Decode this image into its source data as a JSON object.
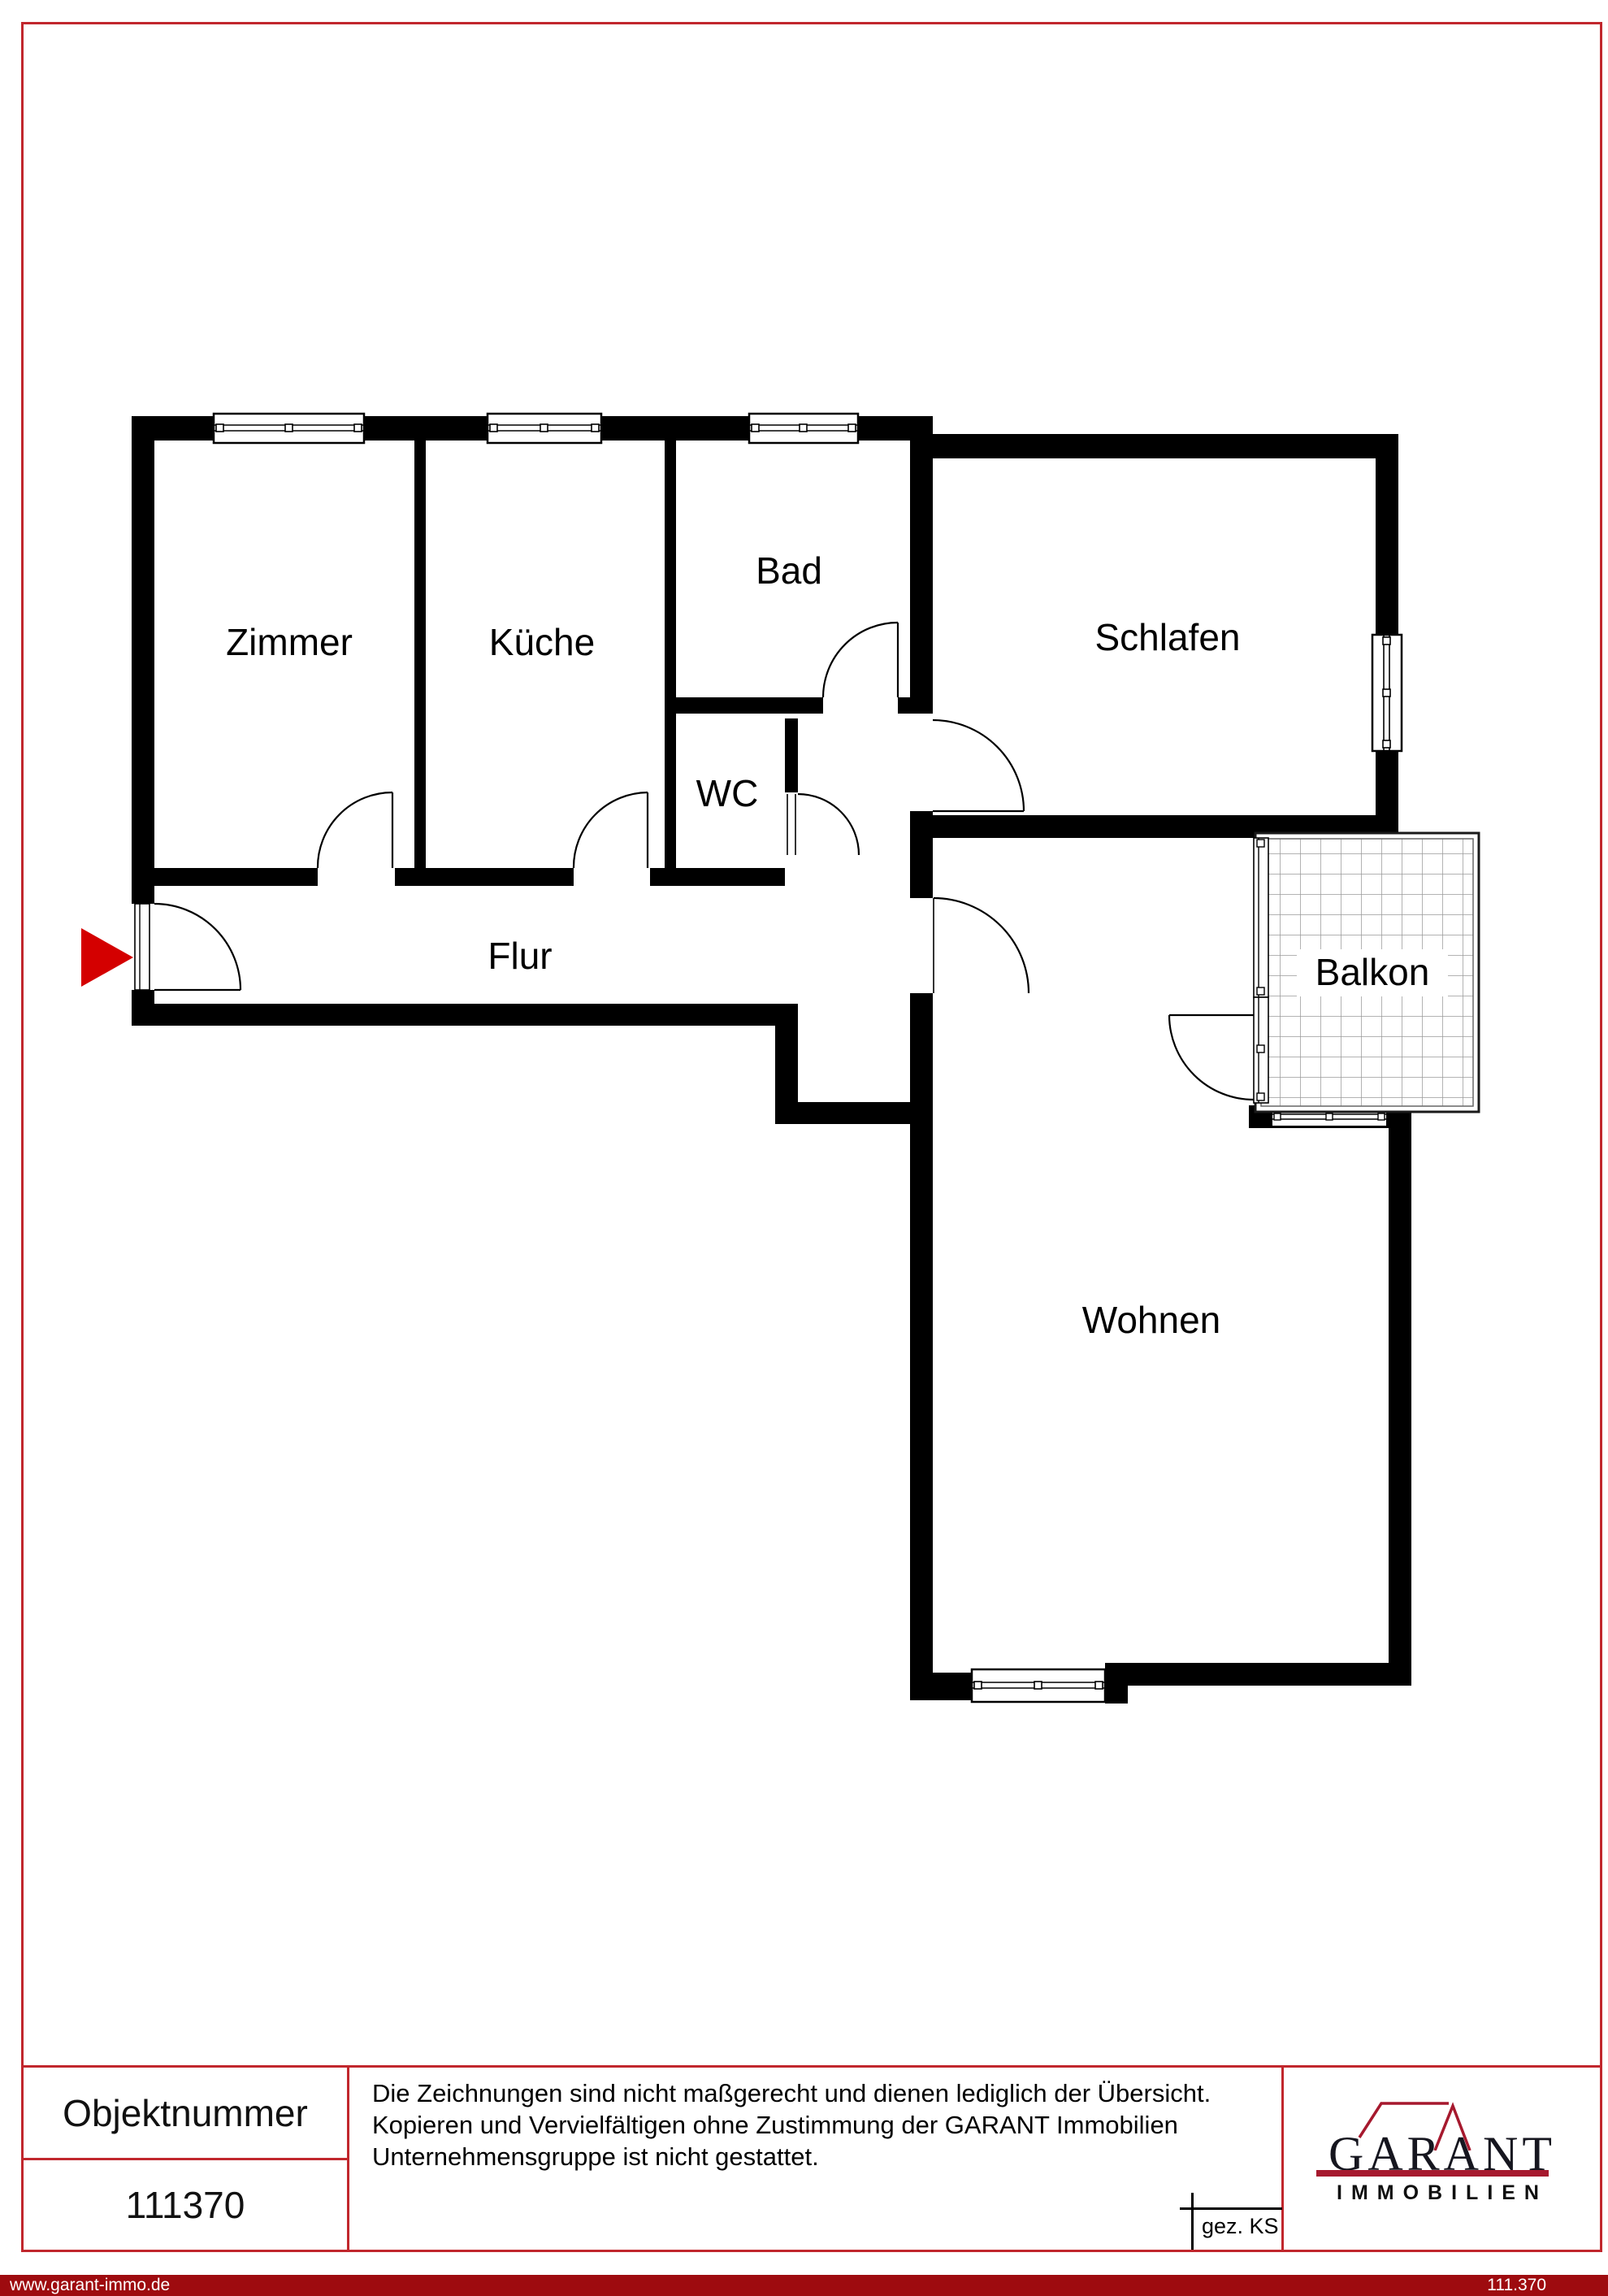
{
  "page": {
    "background": "#ffffff",
    "border_color": "#c1272d",
    "wall_color": "#000000"
  },
  "floor_plan": {
    "labels": {
      "zimmer": "Zimmer",
      "kueche": "Küche",
      "bad": "Bad",
      "wc": "WC",
      "schlafen": "Schlafen",
      "flur": "Flur",
      "balkon": "Balkon",
      "wohnen": "Wohnen"
    },
    "entrance_arrow_color": "#d40000"
  },
  "footer": {
    "object_number_label": "Objektnummer",
    "object_number": "111370",
    "disclaimer": {
      "line1": "Die Zeichnungen sind nicht maßgerecht und dienen lediglich der Übersicht.",
      "line2": "Kopieren und Vervielfältigen ohne Zustimmung der GARANT Immobilien",
      "line3": "Unternehmensgruppe ist nicht gestattet."
    },
    "signature": "gez. KS",
    "logo": {
      "word": "GARANT",
      "subtitle": "IMMOBILIEN",
      "accent_color": "#a6192e",
      "text_color": "#16161f"
    }
  },
  "bottom_bar": {
    "website": "www.garant-immo.de",
    "reference": "111.370",
    "background": "#9e0b0f"
  }
}
